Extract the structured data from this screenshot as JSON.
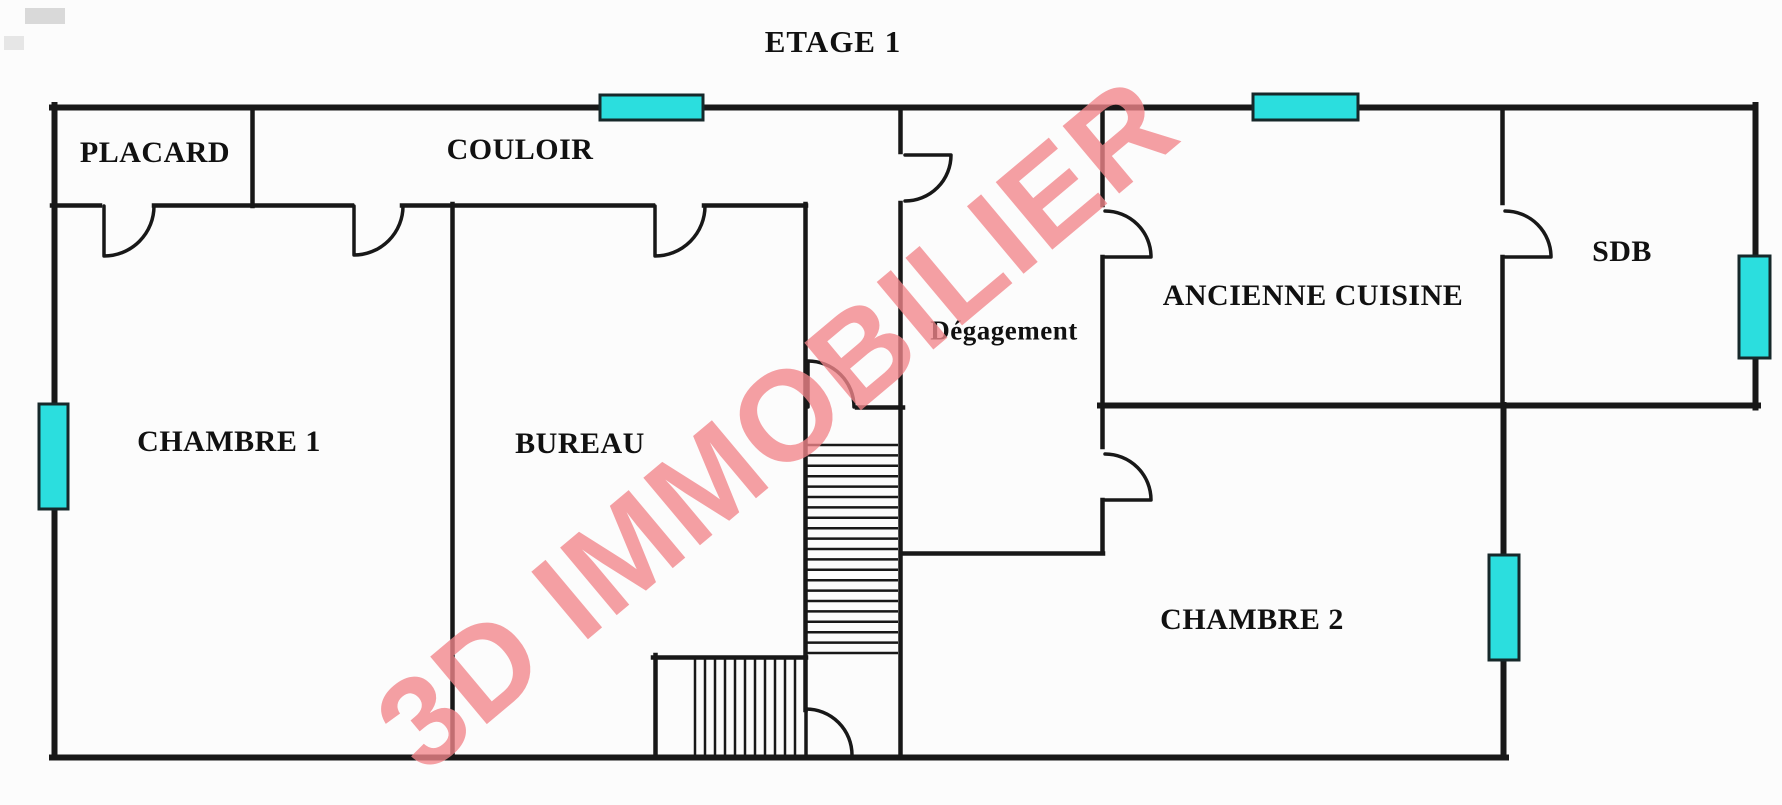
{
  "title": "ETAGE 1",
  "watermark": {
    "text": "3D IMMOBILIER",
    "angle_deg": -40
  },
  "colors": {
    "background": "#fcfcfc",
    "wall": "#181818",
    "window": "#2bdede",
    "label": "#111111",
    "watermark": "#f2868b"
  },
  "rooms": [
    {
      "label": "PLACARD"
    },
    {
      "label": "COULOIR"
    },
    {
      "label": "CHAMBRE 1"
    },
    {
      "label": "BUREAU"
    },
    {
      "label": "Dégagement"
    },
    {
      "label": "ANCIENNE CUISINE"
    },
    {
      "label": "SDB"
    },
    {
      "label": "CHAMBRE 2"
    }
  ],
  "windows": [
    {
      "name": "window-couloir-top"
    },
    {
      "name": "window-cuisine-top"
    },
    {
      "name": "window-chambre1-left"
    },
    {
      "name": "window-sdb-right"
    },
    {
      "name": "window-chambre2-right"
    }
  ],
  "doors": [
    {
      "name": "door-placard"
    },
    {
      "name": "door-chambre1"
    },
    {
      "name": "door-bureau"
    },
    {
      "name": "door-degagement"
    },
    {
      "name": "door-cuisine"
    },
    {
      "name": "door-sdb"
    },
    {
      "name": "door-chambre2"
    },
    {
      "name": "door-stairs-top"
    },
    {
      "name": "door-stairs-bottom"
    }
  ],
  "stairs": {
    "upper_flight_treads": 21,
    "lower_flight_treads": 11
  }
}
